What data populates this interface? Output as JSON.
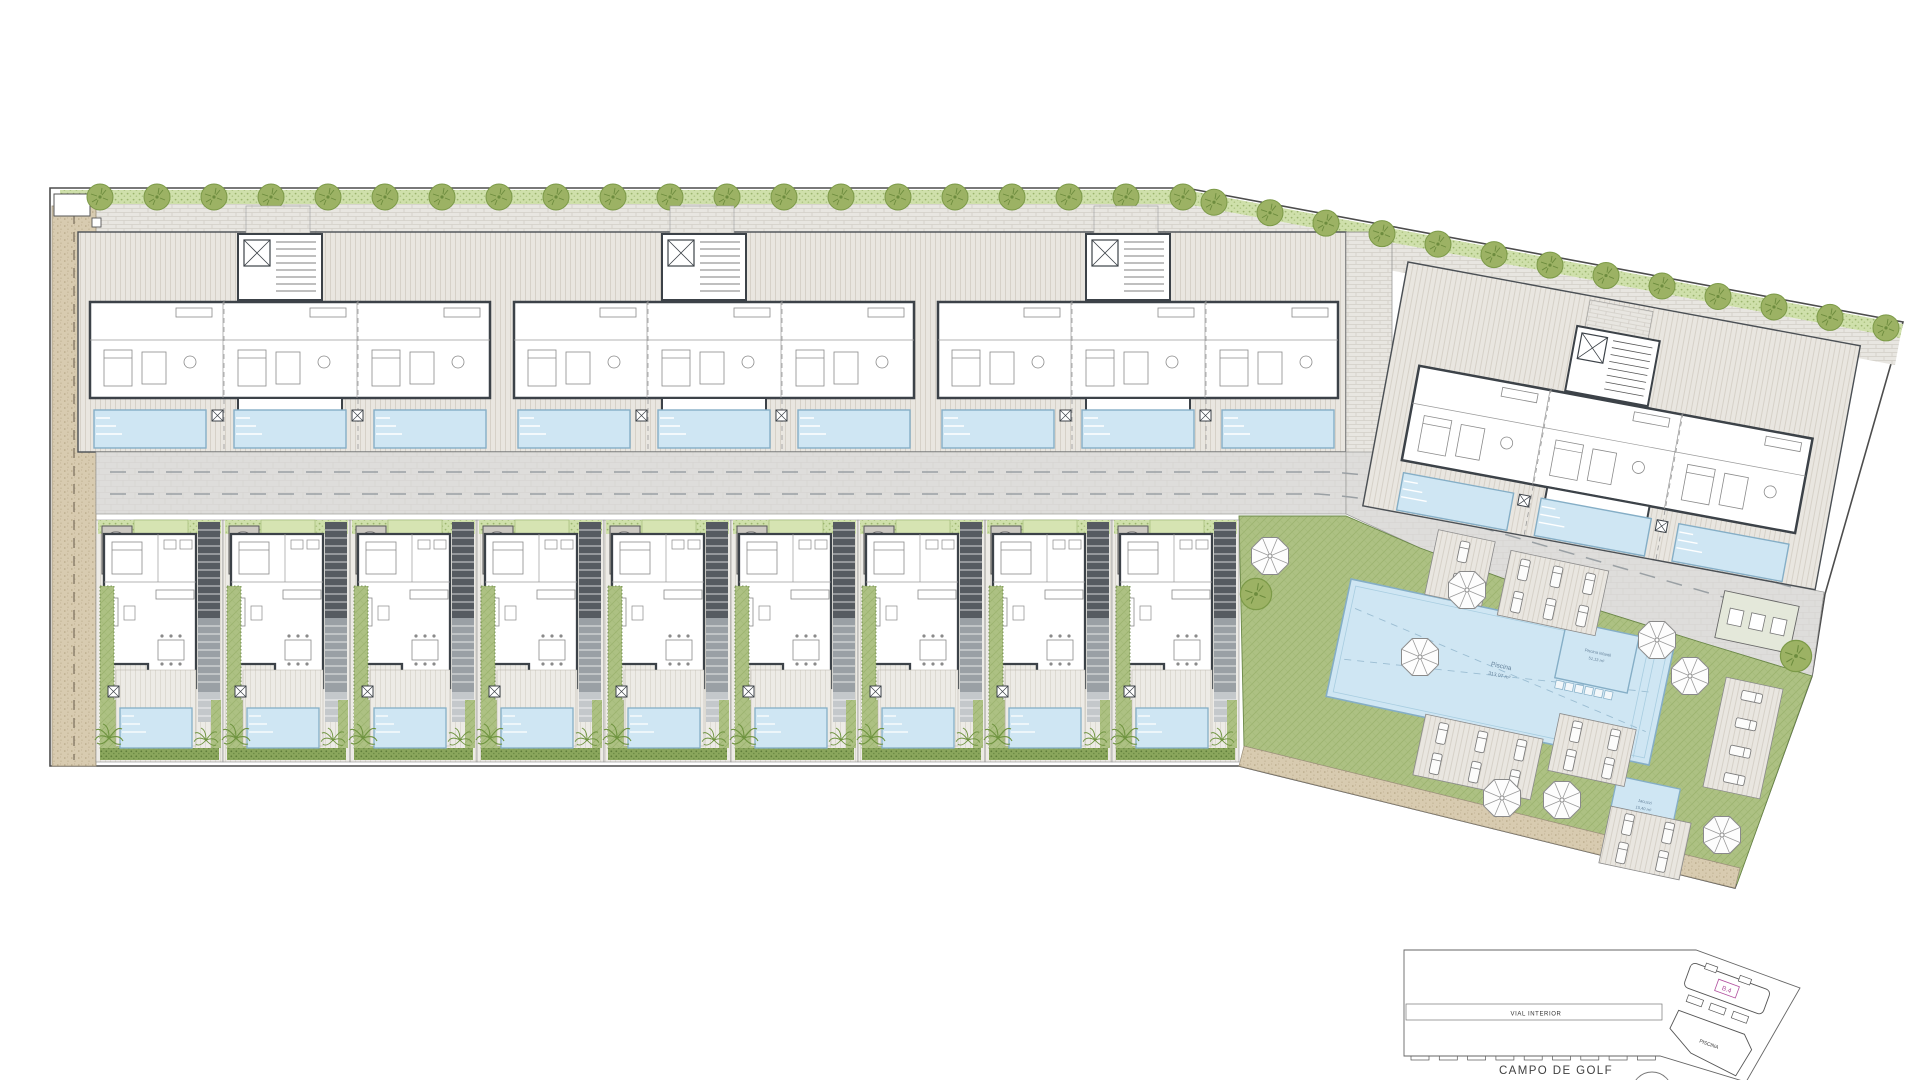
{
  "plan": {
    "key_plan": {
      "top_blocks": [
        "B.1",
        "B.2",
        "B.3"
      ],
      "right_block": "B.4",
      "villas": [
        "V1",
        "V2",
        "V3",
        "V4",
        "V5",
        "V6",
        "V7",
        "V8",
        "V9"
      ],
      "road_label": "VIAL INTERIOR",
      "golf_label": "CAMPO DE GOLF",
      "pool_area_label": "PISCINA"
    },
    "amenity": {
      "main_pool": {
        "name": "Piscina",
        "area": "313,07 m²"
      },
      "kids_pool": {
        "name": "Piscina infantil",
        "area": "51,13 m²"
      },
      "jacuzzi": {
        "name": "Jacuzzi",
        "area": "15,40 m²"
      }
    },
    "counts": {
      "villas": 9,
      "top_blocks": 3,
      "units_per_block": 3,
      "pools_per_block": 3
    },
    "colors": {
      "wall": "#3c4248",
      "deck": "#e9e6e0",
      "deck_line": "#d6d1c8",
      "road": "#dedddb",
      "road_dash": "#9aa0a4",
      "pool": "#cfe6f3",
      "pool_edge": "#85aec6",
      "green": "#adc183",
      "green_line": "#9cb36f",
      "hedge": "#86a457",
      "hedge_dot": "#5f7d3a",
      "hedge_light": "#cfe0ab",
      "sand": "#d8cbb0",
      "sand_dot": "#b6a686",
      "tree": "#9cb264",
      "tree_edge": "#7c9a48",
      "palm": "#6f9440",
      "label_magenta": "#b1509e",
      "outline": "#555555",
      "light_outline": "#8a8a8a",
      "brick": "#e8e6e1",
      "brick_line": "#d2cec7",
      "white": "#ffffff"
    },
    "icons": {
      "tree-icon": "round canopy with twig strokes",
      "palm-icon": "radial frond star",
      "parasol-icon": "octagon umbrella with 8 spokes",
      "sun-lounger-icon": "small rounded rectangle with headrest line",
      "bathtub-icon": "oval tub in grey niche",
      "stairs-icon": "striped stair strip",
      "elevator-icon": "crossed square",
      "utility-box-icon": "crossed small square"
    }
  }
}
